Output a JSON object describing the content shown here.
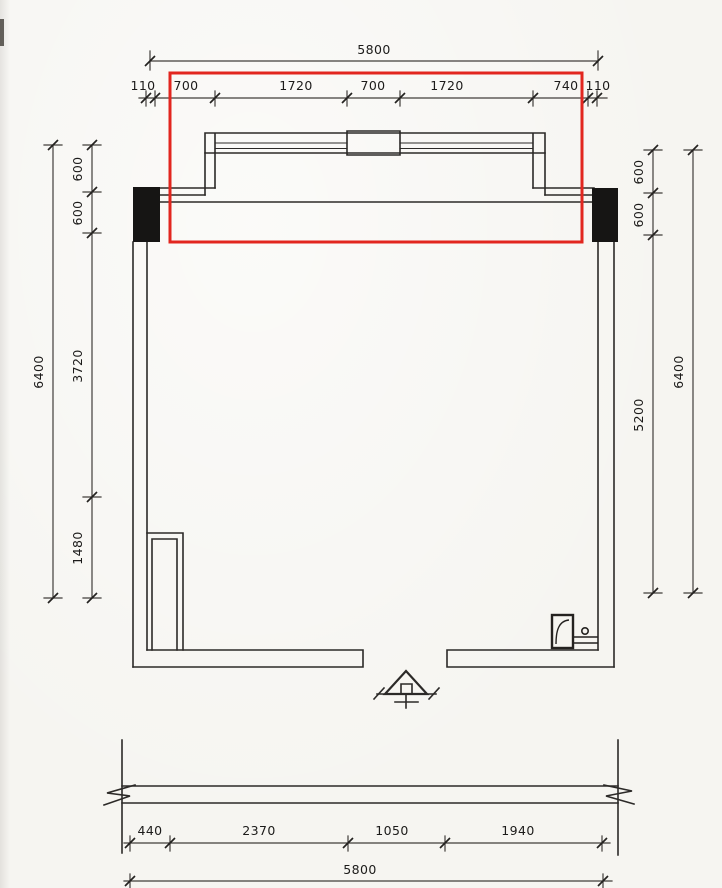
{
  "drawing": {
    "kind": "scanned architectural floor plan",
    "highlighted_area": "bay window and top wall zone outlined in red"
  },
  "dimensions": {
    "top_overall": "5800",
    "top_segments": [
      "110",
      "700",
      "1720",
      "700",
      "1720",
      "740",
      "110"
    ],
    "left_outer": "6400",
    "left_segments": [
      "600",
      "600",
      "3720",
      "1480"
    ],
    "right_segments": [
      "600",
      "600",
      "5200"
    ],
    "right_outer": "6400",
    "bottom_segments": [
      "440",
      "2370",
      "1050",
      "1940"
    ],
    "bottom_overall": "5800"
  },
  "colors": {
    "highlight_red": "#e2261f",
    "line": "#2c2a28",
    "column_fill": "#161514",
    "paper": "#f6f5f1"
  }
}
